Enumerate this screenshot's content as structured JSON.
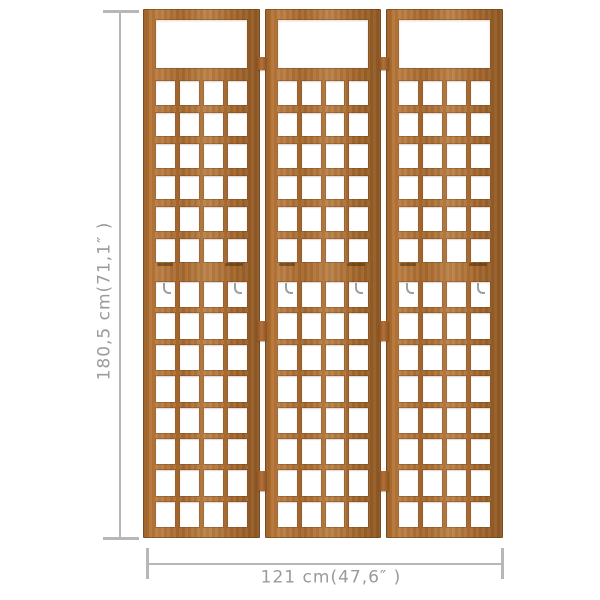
{
  "diagram": {
    "background": "#ffffff",
    "height_dimension": {
      "label": "180,5 cm(71,1″ )"
    },
    "width_dimension": {
      "label": "121 cm(47,6″ )"
    },
    "dimension_line_color": "#b7b7b7",
    "dimension_label_color": "#9a9a9a"
  },
  "divider": {
    "description": "3-panel solid wood trellis room divider",
    "panel_count": 3,
    "colors": {
      "wood_base": "#b3702f",
      "wood_light": "#c6823c",
      "wood_dark": "#8a5120",
      "hook_metal": "#9ba0a3"
    },
    "upper_lattice": {
      "rows": 6,
      "cols": 4
    },
    "lower_lattice": {
      "rows": 8,
      "cols": 4
    },
    "hinges_per_gap": 3,
    "hinge_tops_px": [
      48,
      312,
      462
    ],
    "hinge_heights_px": [
      13,
      20,
      20
    ],
    "hooks_per_panel": 2
  }
}
